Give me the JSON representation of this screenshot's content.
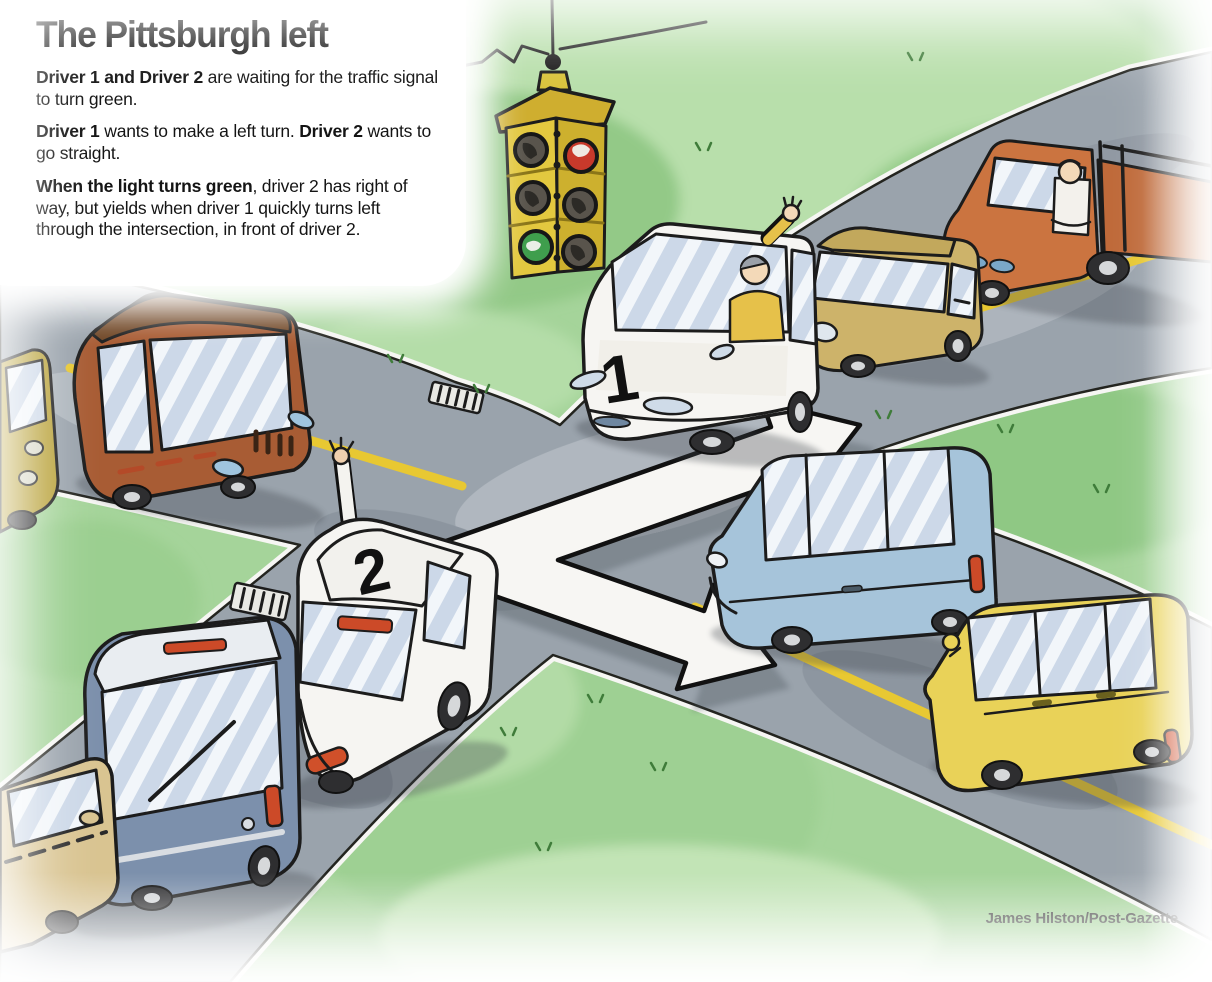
{
  "title": "The Pittsburgh left",
  "intro": {
    "p1": {
      "b1": "Driver 1 and Driver 2",
      "r1": " are waiting for the traffic signal to turn green."
    },
    "p2": {
      "b1": "Driver 1",
      "r1": " wants to make a left turn. ",
      "b2": "Driver 2",
      "r2": " wants to go straight."
    },
    "p3": {
      "b1": "When the light turns green",
      "r1": ", driver 2 has right of way, but yields when driver 1 quickly turns left through the intersection, in front of driver 2."
    }
  },
  "credit": "James Hilston/Post-Gazette",
  "scene": {
    "car1_label": "1",
    "car2_label": "2",
    "traffic_light": {
      "left_face_lit": "green",
      "right_face_lit": "red",
      "style": "vintage hanging 4-way signal"
    },
    "arrow": {
      "shape": "bent two-headed white arrow through intersection",
      "head_a": "points up-right along driver 2's straight path",
      "head_b": "points down-right along driver 1's left-turn path"
    },
    "vehicles": [
      {
        "id": "car-1",
        "color": "white minivan",
        "role": "Driver 1, waving, waiting to turn left"
      },
      {
        "id": "car-2",
        "color": "white car",
        "role": "Driver 2, arm out window, going straight"
      },
      {
        "id": "tan-hatchback",
        "color": "tan",
        "role": "queued behind car 1"
      },
      {
        "id": "orange-pickup",
        "color": "orange",
        "role": "queued behind tan car, driver arm resting"
      },
      {
        "id": "brown-car",
        "color": "rust brown",
        "role": "approaching from the left street"
      },
      {
        "id": "olive-car",
        "color": "olive yellow",
        "role": "partially visible at left edge"
      },
      {
        "id": "slate-van",
        "color": "slate blue",
        "role": "queued behind car 2"
      },
      {
        "id": "tan-car-rear",
        "color": "tan",
        "role": "partially visible bottom-left"
      },
      {
        "id": "blue-car",
        "color": "light blue",
        "role": "queued on right street"
      },
      {
        "id": "yellow-wagon",
        "color": "yellow",
        "role": "queued behind blue car"
      }
    ],
    "colors": {
      "grass": "#a5d49a",
      "road": "#9aa3ac",
      "lane_line_yellow": "#e8c832",
      "arrow_white": "#f7f6f3",
      "signal_body_yellow": "#d9c23a",
      "signal_red": "#c8392b",
      "signal_green": "#3f9e4d",
      "taillight_red": "#cc4a28"
    }
  }
}
